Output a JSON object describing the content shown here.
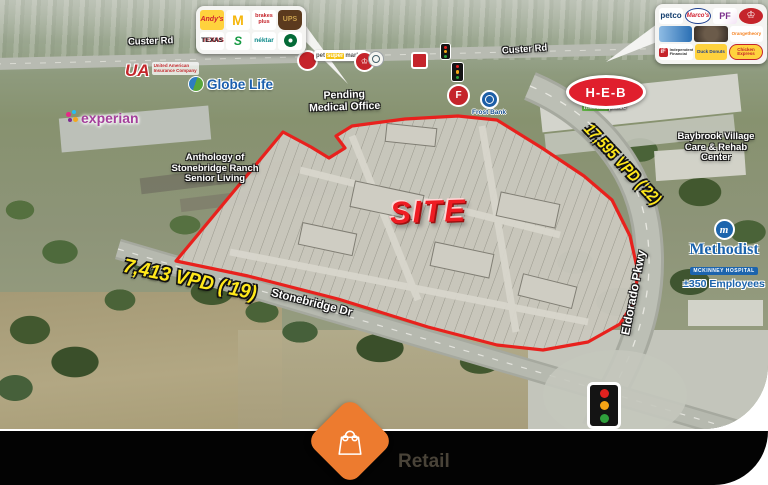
{
  "footer": {
    "category_label": "Retail"
  },
  "site_plan": {
    "site_label": "SITE"
  },
  "traffic_counts": {
    "eldorado": "17,595 VPD ('22)",
    "stonebridge": "7,413 VPD ('19)"
  },
  "road_labels": {
    "custer_left": "Custer Rd",
    "custer_right": "Custer Rd",
    "stonebridge": "Stonebridge Dr",
    "eldorado": "Eldorado Pkwy"
  },
  "place_labels": {
    "pending_medical": {
      "line1": "Pending",
      "line2": "Medical Office"
    },
    "anthology": {
      "line1": "Anthology of",
      "line2": "Stonebridge Ranch",
      "line3": "Senior Living"
    },
    "baybrook": {
      "line1": "Baybrook Village",
      "line2": "Care & Rehab",
      "line3": "Center"
    },
    "methodist": {
      "name": "Methodist",
      "subtitle": "MCKINNEY HOSPITAL",
      "employees": "±350 Employees",
      "mark": "m"
    }
  },
  "onmap_logos": {
    "experian": "experian",
    "globe_life": "Globe Life",
    "ua_mark": "UA",
    "ua_line1": "United American",
    "ua_line2": "Insurance Company",
    "kroger_name": "Kroger",
    "kroger_market": "market",
    "kroger_place": "place",
    "heb": "H-E-B",
    "frost_bank": "Frost Bank",
    "pet_word1": "pet",
    "pet_word2": "super",
    "pet_word3": "market",
    "crown": "♔",
    "f_mark": "F"
  },
  "logo_panels": {
    "left": {
      "items": [
        {
          "name": "Andy's Frozen Custard",
          "glyph": "Andy's"
        },
        {
          "name": "McDonald's",
          "glyph": "M"
        },
        {
          "name": "Brakes Plus",
          "glyph": "brakes plus"
        },
        {
          "name": "UPS",
          "glyph": "UPS"
        },
        {
          "name": "Texas Roadhouse",
          "glyph": "TEXAS"
        },
        {
          "name": "Subway",
          "glyph": "S"
        },
        {
          "name": "Nektar Juice Bar",
          "glyph": "néktar"
        },
        {
          "name": "Starbucks",
          "glyph": ""
        }
      ]
    },
    "right": {
      "items": [
        {
          "name": "Petco",
          "glyph": "petco"
        },
        {
          "name": "Marco's Pizza",
          "glyph": "Marco's"
        },
        {
          "name": "Planet Fitness",
          "glyph": "PF"
        },
        {
          "name": "Smoothie King",
          "glyph": "♔"
        },
        {
          "name": "unidentified logo",
          "glyph": ""
        },
        {
          "name": "unidentified logo",
          "glyph": ""
        },
        {
          "name": "Orangetheory Fitness",
          "glyph": "Orangetheory"
        },
        {
          "name": "Independent Financial",
          "glyph": "iF",
          "text": "Independent Financial"
        },
        {
          "name": "Duck Donuts",
          "glyph": "Duck Donuts"
        },
        {
          "name": "Chicken Express",
          "glyph": "Chicken Express"
        }
      ]
    }
  },
  "colors": {
    "pin_orange": "#ED7B2F",
    "site_red": "#E8211D",
    "vpd_yellow": "#FFE81A"
  }
}
